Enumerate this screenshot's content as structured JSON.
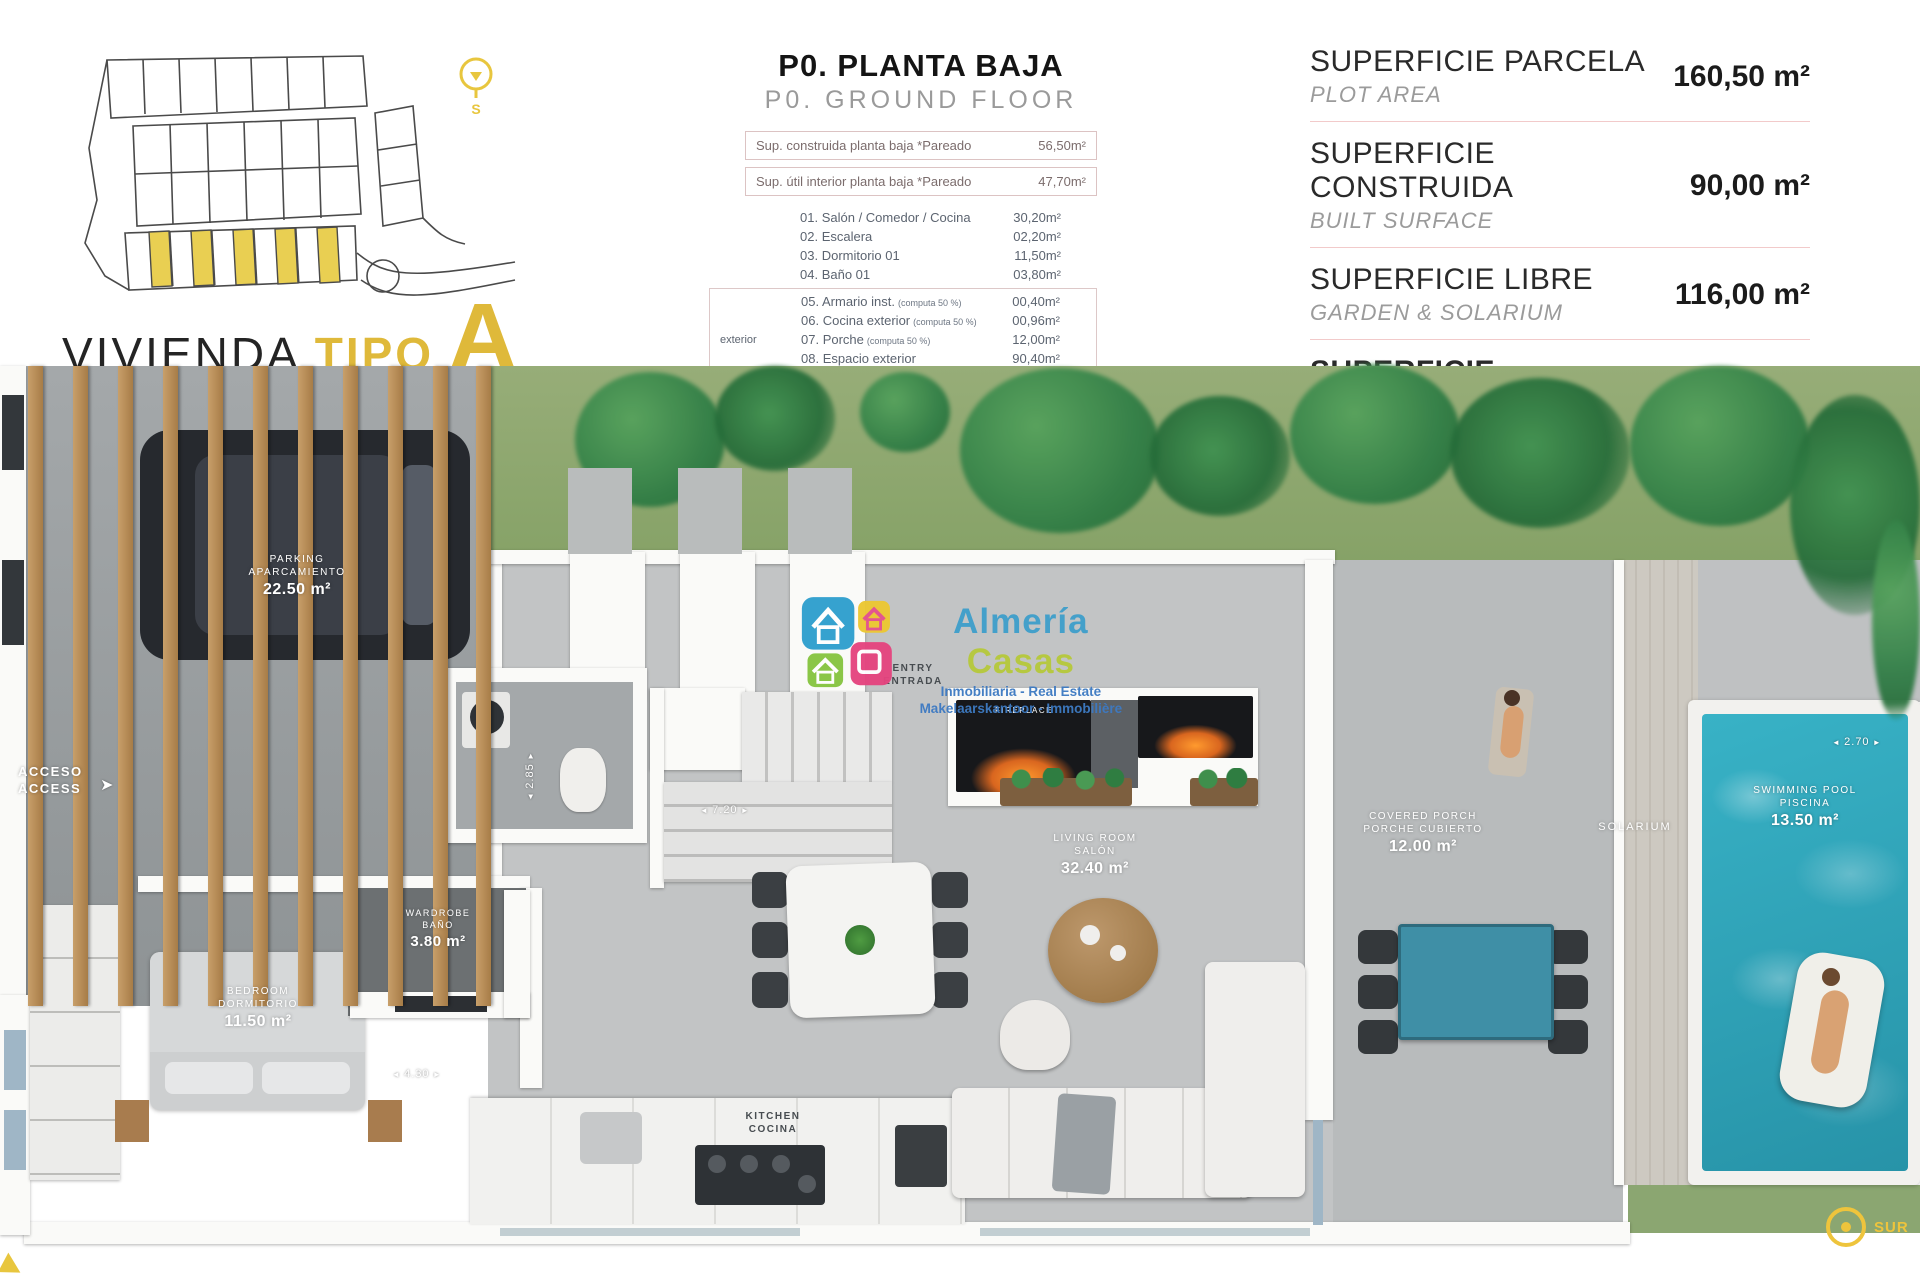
{
  "title": {
    "black": "VIVIENDA",
    "yellow": "TIPO",
    "letter": "A"
  },
  "plan_header": {
    "title": "P0. PLANTA BAJA",
    "subtitle": "P0. GROUND FLOOR"
  },
  "summary_rows": [
    {
      "label": "Sup. construida planta baja *Pareado",
      "value": "56,50m²"
    },
    {
      "label": "Sup. útil interior planta baja *Pareado",
      "value": "47,70m²"
    }
  ],
  "exterior_label": "exterior",
  "rooms": [
    {
      "num": "01.",
      "name": "Salón / Comedor / Cocina",
      "note": "",
      "value": "30,20m²"
    },
    {
      "num": "02.",
      "name": "Escalera",
      "note": "",
      "value": "02,20m²"
    },
    {
      "num": "03.",
      "name": "Dormitorio 01",
      "note": "",
      "value": "11,50m²"
    },
    {
      "num": "04.",
      "name": "Baño 01",
      "note": "",
      "value": "03,80m²"
    },
    {
      "num": "05.",
      "name": "Armario inst.",
      "note": "(computa 50 %)",
      "value": "00,40m²"
    },
    {
      "num": "06.",
      "name": "Cocina exterior",
      "note": "(computa 50 %)",
      "value": "00,96m²"
    },
    {
      "num": "07.",
      "name": "Porche",
      "note": "(computa 50 %)",
      "value": "12,00m²"
    },
    {
      "num": "08.",
      "name": "Espacio exterior",
      "note": "",
      "value": "90,40m²"
    },
    {
      "num": "09.",
      "name": "Piscina",
      "note": "",
      "value": "12,70m²"
    }
  ],
  "surfaces": [
    {
      "es": "SUPERFICIE PARCELA",
      "en": "PLOT AREA",
      "value": "160,50 m²"
    },
    {
      "es": "SUPERFICIE CONSTRUIDA",
      "en": "BUILT SURFACE",
      "value": "90,00 m²"
    },
    {
      "es": "SUPERFICIE LIBRE",
      "en": "GARDEN & SOLARIUM",
      "value": "116,00 m²"
    },
    {
      "es": "SUPERFICIE DISFRUTABLE",
      "en": "INT+EXTERIOR SURFACE",
      "value": "201,70 m²"
    }
  ],
  "plan": {
    "parking": {
      "en": "PARKING",
      "es": "APARCAMIENTO",
      "area": "22.50 m²"
    },
    "access": {
      "es": "ACCESO",
      "en": "ACCESS"
    },
    "entry": {
      "en": "ENTRY",
      "es": "ENTRADA"
    },
    "bedroom": {
      "en": "BEDROOM",
      "es": "DORMITORIO",
      "area": "11.50 m²"
    },
    "wardrobe": {
      "en": "WARDROBE",
      "es": "BAÑO",
      "area": "3.80 m²"
    },
    "living": {
      "en": "LIVING ROOM",
      "es": "SALÓN",
      "area": "32.40 m²"
    },
    "kitchen": {
      "en": "KITCHEN",
      "es": "COCINA"
    },
    "porch": {
      "en": "COVERED PORCH",
      "es": "PORCHE CUBIERTO",
      "area": "12.00 m²"
    },
    "solarium": "SOLARIUM",
    "pool": {
      "en": "SWIMMING POOL",
      "es": "PISCINA",
      "area": "13.50 m²"
    },
    "fireplace": "FIREPLACE",
    "dims": {
      "stairs": "7.20",
      "bath": "2.85",
      "bedroom": "4.30",
      "pool": "2.70"
    },
    "compass": "SUR"
  },
  "watermark": {
    "brand1": "Almería",
    "brand2": "Casas",
    "line1": "Inmobiliaria - Real Estate",
    "line2": "Makelaarskantoor - Immobilière"
  },
  "colors": {
    "accent_yellow": "#dfb93a",
    "plot_yellow": "#e9cf52",
    "divider_pink": "#f2caca",
    "pool_water": "#2fa9bd",
    "grass": "#8fa870",
    "wood": "#b6874f"
  }
}
